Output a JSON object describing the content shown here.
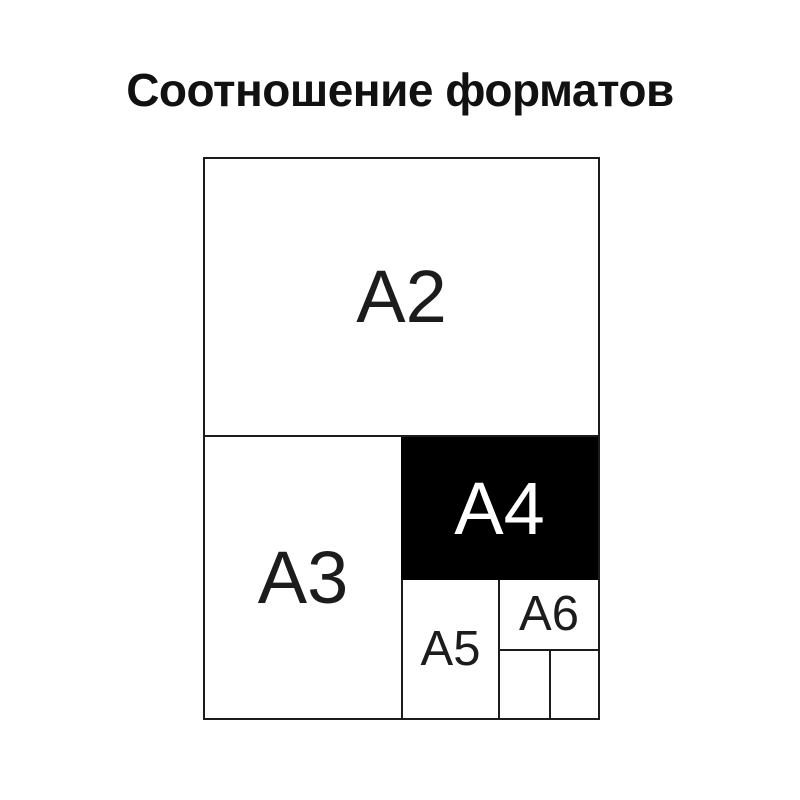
{
  "title": "Соотношение форматов",
  "diagram": {
    "description": "Nested rectangles showing relative sizes of paper formats",
    "formats": {
      "a2": {
        "label": "A2",
        "highlighted": false
      },
      "a3": {
        "label": "A3",
        "highlighted": false
      },
      "a4": {
        "label": "A4",
        "highlighted": true
      },
      "a5": {
        "label": "A5",
        "highlighted": false
      },
      "a6": {
        "label": "A6",
        "highlighted": false
      }
    }
  },
  "colors": {
    "background": "#ffffff",
    "line": "#1c1c1c",
    "text": "#111111",
    "highlight_fill": "#000000",
    "highlight_text": "#ffffff"
  }
}
